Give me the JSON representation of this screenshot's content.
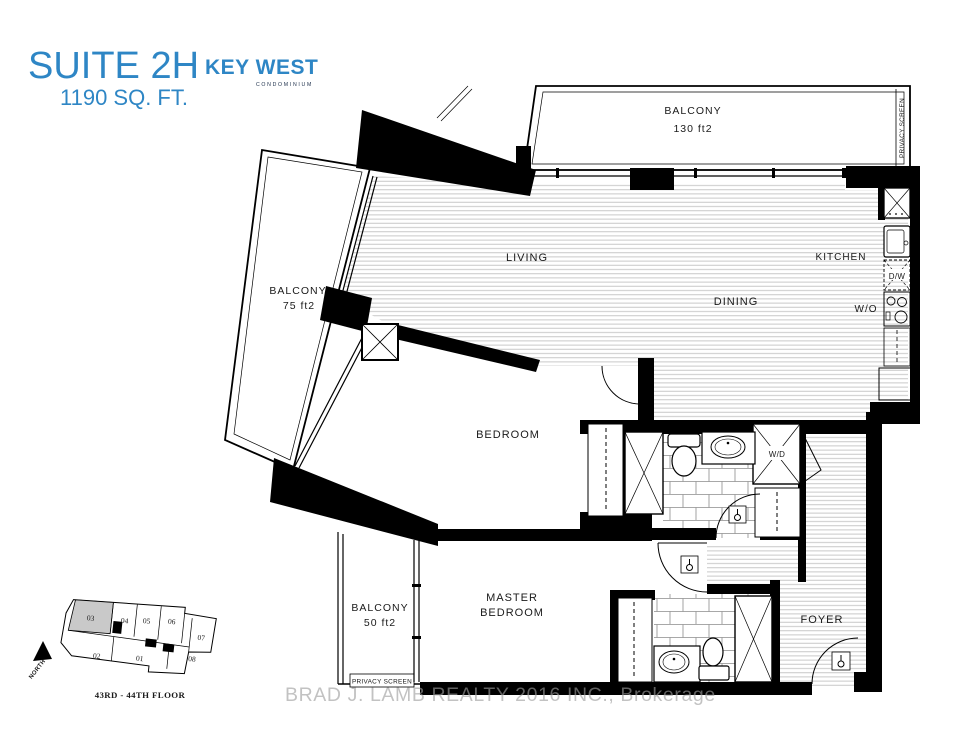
{
  "header": {
    "suite": "SUITE 2H",
    "area": "1190 SQ. FT."
  },
  "logo": {
    "name": "KEY WEST",
    "tagline": "CONDOMINIUM"
  },
  "plan": {
    "rooms": {
      "living": "LIVING",
      "dining": "DINING",
      "kitchen": "KITCHEN",
      "bedroom": "BEDROOM",
      "master_line1": "MASTER",
      "master_line2": "BEDROOM",
      "foyer": "FOYER"
    },
    "appliances": {
      "dw": "D/W",
      "wo": "W/O",
      "wd": "W/D"
    },
    "balconies": {
      "top_name": "BALCONY",
      "top_area": "130 ft2",
      "left_name": "BALCONY",
      "left_area": "75 ft2",
      "bottom_name": "BALCONY",
      "bottom_area": "50 ft2"
    },
    "privacy_top": "PRIVACY SCREEN",
    "privacy_bottom": "PRIVACY SCREEN"
  },
  "keyplan": {
    "units": [
      "01",
      "02",
      "03",
      "04",
      "05",
      "06",
      "07",
      "08"
    ],
    "floor": "43RD - 44TH FLOOR",
    "north": "NORTH"
  },
  "watermark": "BRAD J. LAMB REALTY 2016 INC., Brokerage",
  "colors": {
    "accent": "#2e86c5",
    "logo_navy": "#22344f",
    "highlight_unit": "#c9c9c9"
  }
}
